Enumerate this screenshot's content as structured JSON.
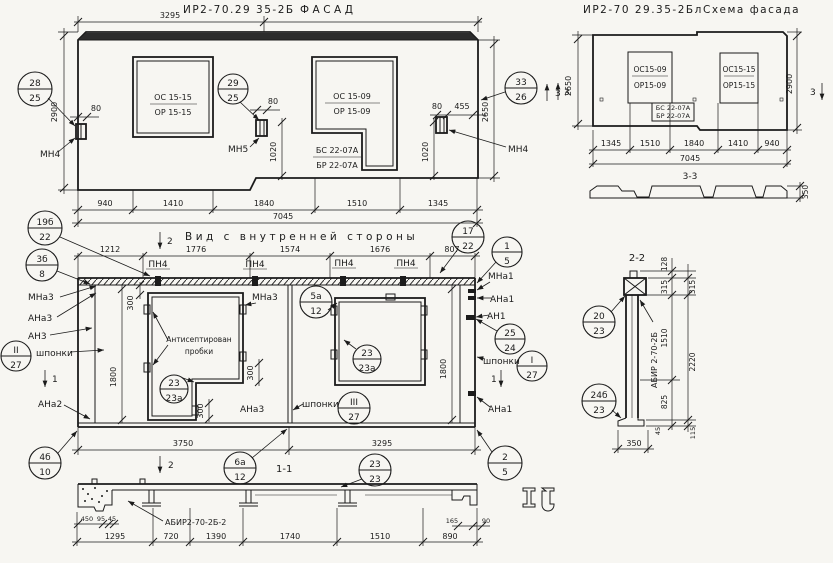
{
  "titles": {
    "facade_code": "ИР2-70.29 35-2Б",
    "facade_name": "ФАСАД",
    "schema_code": "ИР2-70 29.35-2Бл",
    "schema_name": "Схема фасада",
    "interior": "Вид с внутренней стороны",
    "s11": "1-1",
    "s22": "2-2",
    "s33": "3-3"
  },
  "facade": {
    "dim_top": "3295",
    "total": "7045",
    "bot": [
      "940",
      "1410",
      "1840",
      "1510",
      "1345"
    ],
    "h_left": "2900",
    "h_right": "2650",
    "d80l": "80",
    "d80m": "80",
    "d80r": "80",
    "d455": "455",
    "d1020m": "1020",
    "d1020r": "1020",
    "w1_l1": "ОС 15-15",
    "w1_l2": "ОР 15-15",
    "w2_l1": "ОС 15-09",
    "w2_l2": "ОР 15-09",
    "b_l1": "БС 22-07А",
    "b_l2": "БР 22-07А",
    "mn4l": "МН4",
    "mn5": "МН5",
    "mn4r": "МН4",
    "sec3": "3"
  },
  "schema": {
    "w1_l1": "ОС15-09",
    "w1_l2": "ОР15-09",
    "w2_l1": "ОС15-15",
    "w2_l2": "ОР15-15",
    "b_l1": "БС 22-07А",
    "b_l2": "БР 22-07А",
    "h_left": "2650",
    "h_right": "2900",
    "bot": [
      "1345",
      "1510",
      "1840",
      "1410",
      "940"
    ],
    "total": "7045",
    "sec3l": "3",
    "sec3r": "3",
    "d350": "350"
  },
  "interior": {
    "top": [
      "1212",
      "1776",
      "1574",
      "1676",
      "807"
    ],
    "pn4": "ПН4",
    "mna3": "МНа3",
    "ana3": "АНа3",
    "an3": "АН3",
    "shponki": "шпонки",
    "ana2": "АНа2",
    "mna1": "МНа1",
    "ana1": "АНа1",
    "an1": "АН1",
    "plug1": "Антисептирован",
    "plug2": "пробки",
    "d300": "300",
    "d1800": "1800",
    "d3750": "3750",
    "d3295": "3295",
    "sec1": "1",
    "sec2": "2"
  },
  "s11": {
    "label": "АБИР2-70-2Б-2",
    "d450": "450",
    "d95": "95",
    "d45": "45",
    "d165": "165",
    "d90": "90",
    "bot": [
      "1295",
      "720",
      "1390",
      "1740",
      "1510",
      "890"
    ]
  },
  "s22": {
    "label": "АБИР 2-70-2Б",
    "d128": "128",
    "d315a": "315",
    "d315b": "315",
    "d1510": "1510",
    "d2220": "2220",
    "d825": "825",
    "d45": "45",
    "d115": "115",
    "d350": "350"
  },
  "callouts": {
    "c28_25": {
      "t": "28",
      "b": "25"
    },
    "c29_25": {
      "t": "29",
      "b": "25"
    },
    "c33_26": {
      "t": "33",
      "b": "26"
    },
    "c19b_22": {
      "t": "19б",
      "b": "22"
    },
    "c3b_8": {
      "t": "3б",
      "b": "8"
    },
    "c17_22": {
      "t": "17",
      "b": "22"
    },
    "c1_5": {
      "t": "1",
      "b": "5"
    },
    "c5a_12": {
      "t": "5а",
      "b": "12"
    },
    "c23_23a_a": {
      "t": "23",
      "b": "23а"
    },
    "c23_23a_b": {
      "t": "23",
      "b": "23а"
    },
    "cII_27": {
      "t": "II",
      "b": "27"
    },
    "cIII_27": {
      "t": "III",
      "b": "27"
    },
    "cI_27": {
      "t": "I",
      "b": "27"
    },
    "c25_24": {
      "t": "25",
      "b": "24"
    },
    "c4b_10": {
      "t": "4б",
      "b": "10"
    },
    "c6a_12": {
      "t": "6а",
      "b": "12"
    },
    "c23_23": {
      "t": "23",
      "b": "23"
    },
    "c2_5": {
      "t": "2",
      "b": "5"
    },
    "c20_23": {
      "t": "20",
      "b": "23"
    },
    "c24b_23": {
      "t": "24б",
      "b": "23"
    }
  }
}
